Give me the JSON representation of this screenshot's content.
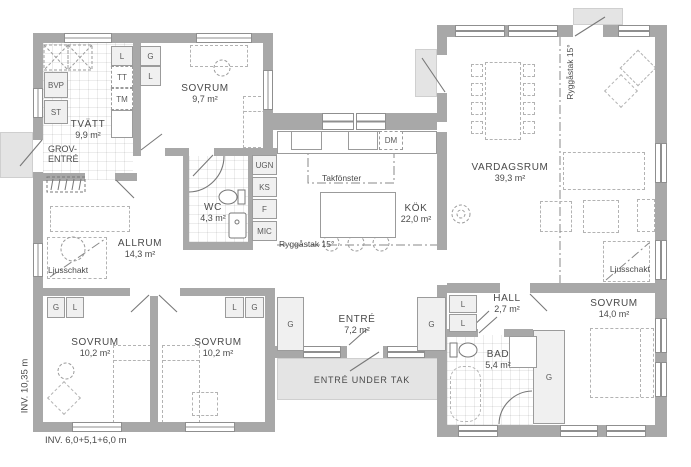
{
  "rooms": {
    "tvatt": {
      "name": "TVÄTT",
      "area": "9,9 m²"
    },
    "grov_entre": {
      "line1": "GROV-",
      "line2": "ENTRÉ"
    },
    "sovrum_97": {
      "name": "SOVRUM",
      "area": "9,7 m²"
    },
    "wc": {
      "name": "WC",
      "area": "4,3 m²"
    },
    "allrum": {
      "name": "ALLRUM",
      "area": "14,3 m²"
    },
    "kok": {
      "name": "KÖK",
      "area": "22,0 m²"
    },
    "vardagsrum": {
      "name": "VARDAGSRUM",
      "area": "39,3 m²"
    },
    "sovrum_102a": {
      "name": "SOVRUM",
      "area": "10,2 m²"
    },
    "sovrum_102b": {
      "name": "SOVRUM",
      "area": "10,2 m²"
    },
    "entre": {
      "name": "ENTRÉ",
      "area": "7,2 m²"
    },
    "hall": {
      "name": "HALL",
      "area": "2,7 m²"
    },
    "bad": {
      "name": "BAD",
      "area": "5,4 m²"
    },
    "sovrum_140": {
      "name": "SOVRUM",
      "area": "14,0 m²"
    }
  },
  "fixtures": {
    "bvp": "BVP",
    "st": "ST",
    "l_tvatt": "L",
    "tt": "TT",
    "tm": "TM",
    "g_sovrum97": "G",
    "l_sovrum97": "L",
    "ugn": "UGN",
    "ks": "KS",
    "f": "F",
    "mic": "MIC",
    "dm": "DM",
    "g_sovrum102a": "G",
    "l_sovrum102a": "L",
    "l_sovrum102b": "L",
    "g_sovrum102b": "G",
    "g_entre_west": "G",
    "g_entre_east": "G",
    "l_hall_1": "L",
    "l_hall_2": "L",
    "g_sovrum140": "G"
  },
  "annotations": {
    "takfonster": "Takfönster",
    "ryggastak_kok": "Ryggåstak 15°",
    "ryggastak_vardagsrum": "Ryggåstak 15°",
    "ljusschakt_allrum": "Ljusschakt",
    "ljusschakt_vardagsrum": "Ljusschakt",
    "entre_under_tak": "ENTRÉ UNDER TAK"
  },
  "dimensions": {
    "left_vertical": "INV. 10,35 m",
    "bottom_horizontal": "INV. 6,0+5,1+6,0 m"
  },
  "colors": {
    "wall": "#a8a8a8",
    "pad": "#e4e4e4",
    "fixture_fill": "#f0f0f0",
    "text": "#4a4a4a",
    "furniture_dash": "#b3b3b3",
    "line": "#787878"
  }
}
